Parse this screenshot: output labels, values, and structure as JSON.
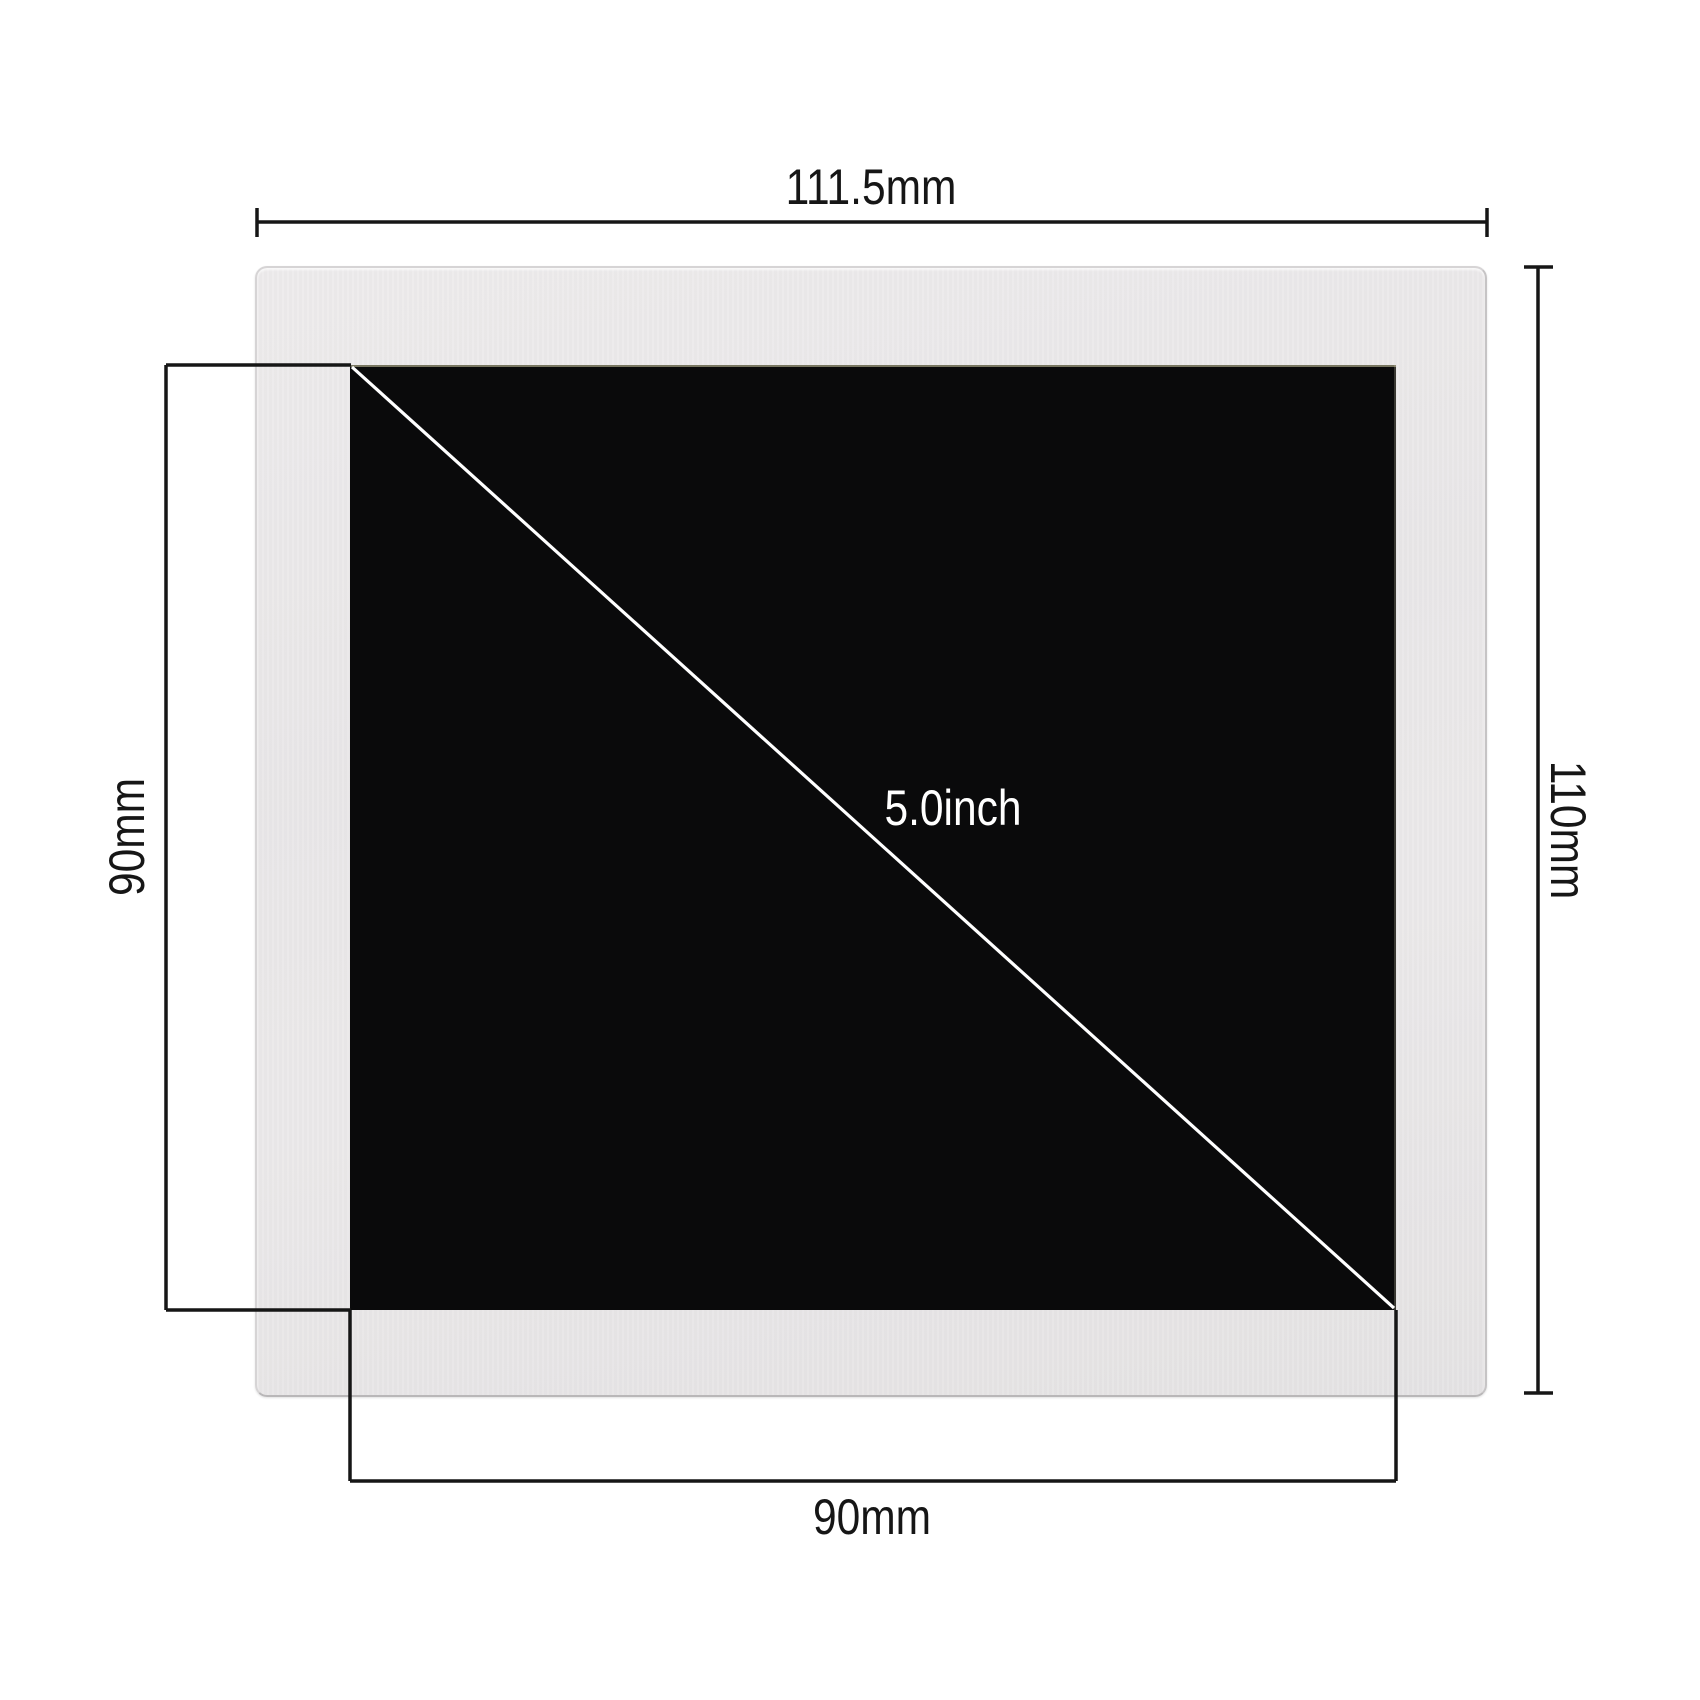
{
  "diagram": {
    "type": "lcd-panel-dimension-drawing",
    "colors": {
      "background": "#ffffff",
      "bezel": "#e9e7e8",
      "active_area": "#0a0a0b",
      "dimension_line": "#161616",
      "diagonal_line": "#ffffff"
    },
    "dimensions": {
      "outer_width": {
        "label": "111.5mm",
        "value": 111.5,
        "unit": "mm",
        "edge": "top"
      },
      "outer_height": {
        "label": "110mm",
        "value": 110,
        "unit": "mm",
        "edge": "right"
      },
      "active_height": {
        "label": "90mm",
        "value": 90,
        "unit": "mm",
        "edge": "left"
      },
      "active_width": {
        "label": "90mm",
        "value": 90,
        "unit": "mm",
        "edge": "bottom"
      },
      "diagonal": {
        "label": "5.0inch",
        "value": 5.0,
        "unit": "inch"
      }
    }
  }
}
